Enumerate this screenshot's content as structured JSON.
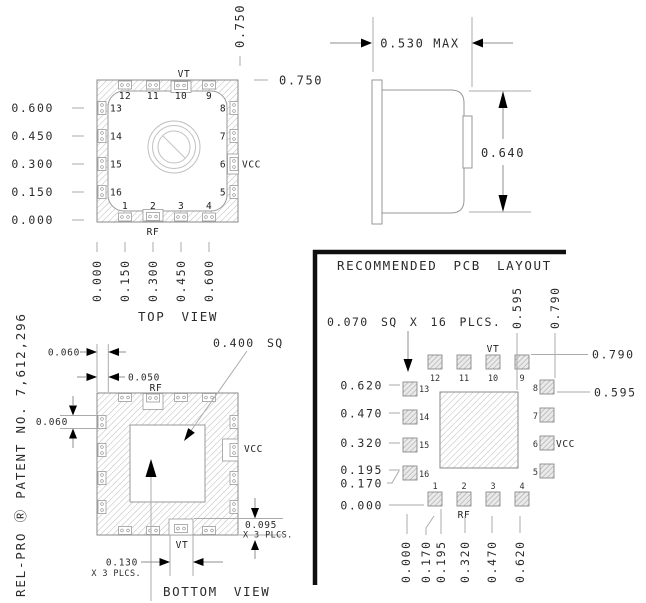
{
  "patent_note": "REL-PRO Ⓡ PATENT NO. 7,612,296",
  "top_view": {
    "title": "TOP VIEW",
    "vt": "VT",
    "rf": "RF",
    "vcc": "VCC",
    "pins_top": [
      "12",
      "11",
      "10",
      "9"
    ],
    "pins_left": [
      "13",
      "14",
      "15",
      "16"
    ],
    "pins_right": [
      "8",
      "7",
      "6",
      "5"
    ],
    "pins_bottom": [
      "1",
      "2",
      "3",
      "4"
    ],
    "y_axis": [
      "0.600",
      "0.450",
      "0.300",
      "0.150",
      "0.000"
    ],
    "x_axis": [
      "0.000",
      "0.150",
      "0.300",
      "0.450",
      "0.600"
    ],
    "overall_width": "0.750",
    "overall_height": "0.750"
  },
  "side_view": {
    "width_max": "0.530 MAX",
    "height": "0.640"
  },
  "bottom_view": {
    "title": "BOTTOM VIEW",
    "vt": "VT",
    "rf": "RF",
    "vcc": "VCC",
    "dim_edge": "0.060",
    "dim_pad_offset": "0.050",
    "dim_pad_height": "0.060",
    "dim_cavity": "0.400 SQ",
    "dim_big_pad_h": "0.095",
    "dim_big_pad_h_note": "X 3 PLCS.",
    "dim_big_pad_w": "0.130",
    "dim_big_pad_w_note": "X 3 PLCS."
  },
  "pcb_layout": {
    "title": "RECOMMENDED PCB LAYOUT",
    "pad_note": "0.070 SQ X 16 PLCS.",
    "vt": "VT",
    "rf": "RF",
    "vcc": "VCC",
    "pads_top": [
      "12",
      "11",
      "10",
      "9"
    ],
    "pads_left": [
      "13",
      "14",
      "15",
      "16"
    ],
    "pads_right": [
      "8",
      "7",
      "6",
      "5"
    ],
    "pads_bottom": [
      "1",
      "2",
      "3",
      "4"
    ],
    "y_axis": [
      "0.620",
      "0.470",
      "0.320",
      "0.195",
      "0.170",
      "0.000"
    ],
    "x_axis": [
      "0.000",
      "0.170",
      "0.195",
      "0.320",
      "0.470",
      "0.620"
    ],
    "x_top": [
      "0.595",
      "0.790"
    ],
    "y_right": [
      "0.790",
      "0.595"
    ]
  }
}
